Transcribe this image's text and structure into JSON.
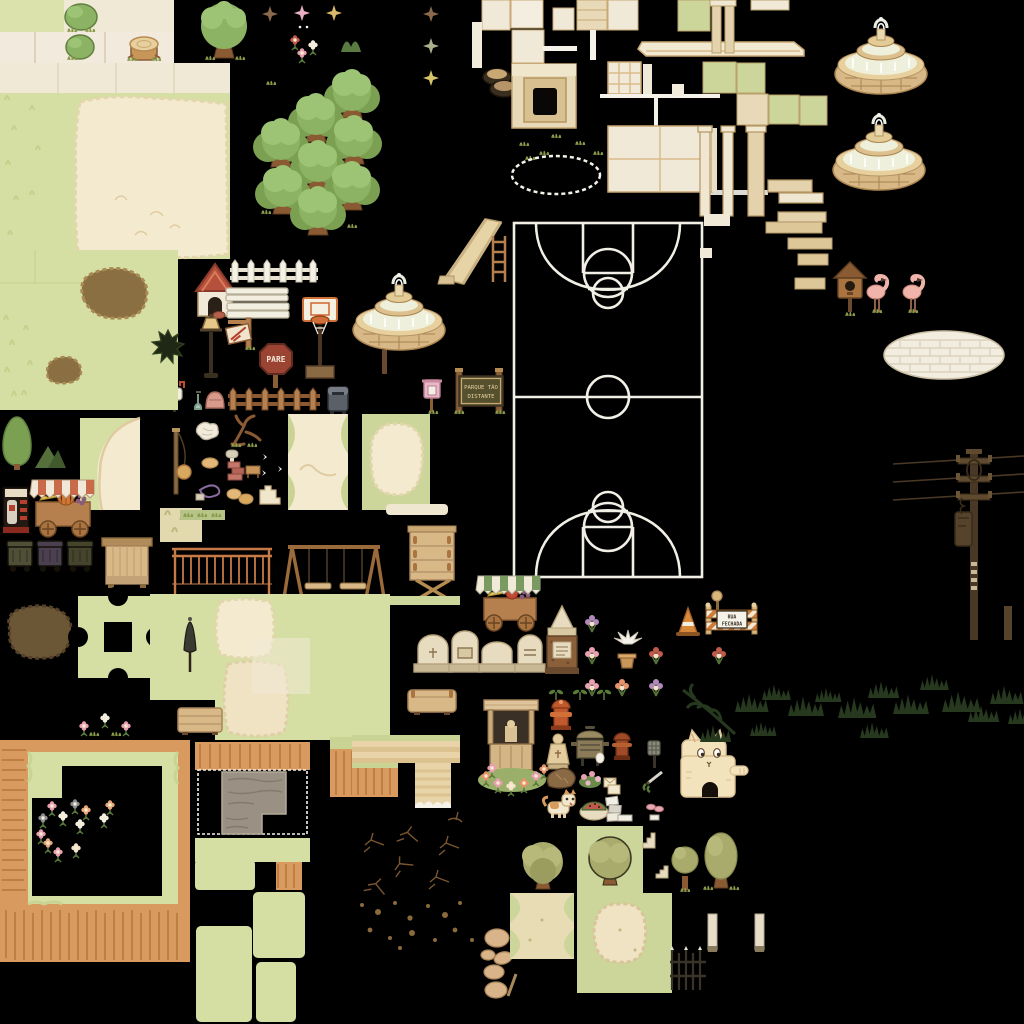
{
  "app": {
    "type": "pixel-art tileset spritesheet",
    "theme": "park and town exterior props",
    "background_color": "#000000",
    "canvas": {
      "width": 1024,
      "height": 1024
    }
  },
  "palette": {
    "pale_green": "#d6dfa3",
    "green_tile": "#ccd69a",
    "cream": "#f0e9d8",
    "sand": "#f3ead0",
    "tan": "#ddc697",
    "wood": "#b5804e",
    "wood_dark": "#8a5a32",
    "cliff_orange": "#d89a5e",
    "cliff_dark": "#c07f42",
    "tree_green": "#8cb364",
    "olive_green": "#a9ab6c",
    "white": "#f5f2ea",
    "stop_red": "#9c4434",
    "awning_red": "#c96a4a",
    "awning_green": "#7a9a62",
    "flamingo_pink": "#f0b4ab",
    "foliage_dark": "#26381e",
    "pole_brown": "#4a3826",
    "cat_cream": "#f2e3bc"
  },
  "signs": {
    "stop": "PARE",
    "park": {
      "line1": "PARQUE TÃO",
      "line2": "DISTANTE"
    },
    "road_closed": {
      "line1": "RUA",
      "line2": "FECHADA"
    }
  },
  "sprites": [
    {
      "name": "ground-tile-green",
      "bbox": [
        0,
        0,
        64,
        32
      ]
    },
    {
      "name": "ground-tile-cream",
      "bbox": [
        64,
        0,
        110,
        32
      ]
    },
    {
      "name": "ground-tile-row",
      "bbox": [
        0,
        32,
        174,
        31
      ]
    },
    {
      "name": "bush-large",
      "bbox": [
        64,
        4,
        32,
        28
      ]
    },
    {
      "name": "bush-small",
      "bbox": [
        66,
        34,
        28,
        26
      ]
    },
    {
      "name": "tree-stump",
      "bbox": [
        128,
        34,
        32,
        26
      ]
    },
    {
      "name": "tree-single",
      "bbox": [
        196,
        2,
        56,
        58
      ]
    },
    {
      "name": "sparkle-brown",
      "bbox": [
        263,
        6,
        15,
        17
      ]
    },
    {
      "name": "sparkle-pink",
      "bbox": [
        296,
        5,
        13,
        18
      ]
    },
    {
      "name": "sparkle-gold",
      "bbox": [
        328,
        6,
        13,
        17
      ]
    },
    {
      "name": "flowers-trio",
      "bbox": [
        288,
        34,
        32,
        28
      ]
    },
    {
      "name": "grass-tuft",
      "bbox": [
        266,
        76,
        12,
        10
      ]
    },
    {
      "name": "grass-arches",
      "bbox": [
        341,
        35,
        21,
        17
      ]
    },
    {
      "name": "sparkle-column",
      "bbox": [
        424,
        5,
        15,
        82
      ]
    },
    {
      "name": "sand-terrace-large",
      "bbox": [
        0,
        63,
        230,
        196
      ]
    },
    {
      "name": "tree-cluster",
      "bbox": [
        255,
        62,
        135,
        172
      ]
    },
    {
      "name": "cream-wall-tiles",
      "bbox": [
        470,
        0,
        170,
        65
      ]
    },
    {
      "name": "tires-stack",
      "bbox": [
        483,
        68,
        30,
        28
      ]
    },
    {
      "name": "sandbox-pit",
      "bbox": [
        512,
        64,
        64,
        64
      ]
    },
    {
      "name": "grass-tufts-scatter",
      "bbox": [
        516,
        130,
        88,
        30
      ]
    },
    {
      "name": "chalk-ellipse",
      "bbox": [
        512,
        156,
        88,
        38
      ]
    },
    {
      "name": "window-grid-tile",
      "bbox": [
        608,
        62,
        33,
        32
      ]
    },
    {
      "name": "cream-floor-2x2",
      "bbox": [
        608,
        126,
        104,
        66
      ]
    },
    {
      "name": "wall-cornice",
      "bbox": [
        640,
        38,
        170,
        22
      ]
    },
    {
      "name": "green-checker-tiles",
      "bbox": [
        678,
        0,
        150,
        126
      ]
    },
    {
      "name": "beige-pillars",
      "bbox": [
        698,
        126,
        66,
        90
      ]
    },
    {
      "name": "beige-steps",
      "bbox": [
        766,
        180,
        60,
        42
      ]
    },
    {
      "name": "fountain-large-1",
      "bbox": [
        835,
        12,
        92,
        86
      ]
    },
    {
      "name": "fountain-large-2",
      "bbox": [
        833,
        106,
        94,
        90
      ]
    },
    {
      "name": "slide",
      "bbox": [
        440,
        215,
        68,
        68
      ]
    },
    {
      "name": "ladder",
      "bbox": [
        490,
        236,
        18,
        46
      ]
    },
    {
      "name": "basketball-court",
      "bbox": [
        513,
        222,
        190,
        356
      ]
    },
    {
      "name": "court-side-fragments",
      "bbox": [
        700,
        214,
        130,
        100
      ]
    },
    {
      "name": "doghouse",
      "bbox": [
        196,
        262,
        40,
        56
      ]
    },
    {
      "name": "dog-bowl",
      "bbox": [
        213,
        312,
        12,
        8
      ]
    },
    {
      "name": "white-picket-fence",
      "bbox": [
        230,
        260,
        90,
        24
      ]
    },
    {
      "name": "white-sign-boards",
      "bbox": [
        226,
        288,
        62,
        32
      ]
    },
    {
      "name": "lamppost",
      "bbox": [
        202,
        316,
        20,
        62
      ]
    },
    {
      "name": "hanging-shop-sign",
      "bbox": [
        226,
        318,
        28,
        28
      ]
    },
    {
      "name": "stop-sign",
      "bbox": [
        262,
        342,
        28,
        48
      ]
    },
    {
      "name": "basketball-hoop",
      "bbox": [
        303,
        296,
        36,
        82
      ]
    },
    {
      "name": "fountain-medium",
      "bbox": [
        352,
        266,
        95,
        88
      ]
    },
    {
      "name": "fountain-post",
      "bbox": [
        382,
        350,
        6,
        24
      ]
    },
    {
      "name": "brown-picket-fence",
      "bbox": [
        228,
        386,
        92,
        26
      ]
    },
    {
      "name": "mailbox-white",
      "bbox": [
        168,
        384,
        16,
        28
      ]
    },
    {
      "name": "shovel-and-pot",
      "bbox": [
        194,
        388,
        28,
        22
      ]
    },
    {
      "name": "mail-bin-blue",
      "bbox": [
        326,
        383,
        24,
        34
      ]
    },
    {
      "name": "birdhouse-pink",
      "bbox": [
        422,
        378,
        20,
        34
      ]
    },
    {
      "name": "park-sign-parque-tao-distante",
      "bbox": [
        452,
        366,
        56,
        50
      ]
    },
    {
      "name": "green-field-dirt-patch",
      "bbox": [
        0,
        250,
        182,
        160
      ]
    },
    {
      "name": "spiky-bush-dark",
      "bbox": [
        156,
        326,
        26,
        34
      ]
    },
    {
      "name": "path-corner-tile",
      "bbox": [
        80,
        418,
        60,
        92
      ]
    },
    {
      "name": "cypress-trees",
      "bbox": [
        0,
        416,
        66,
        52
      ]
    },
    {
      "name": "vending-machine",
      "bbox": [
        3,
        487,
        26,
        46
      ]
    },
    {
      "name": "fruit-cart-red",
      "bbox": [
        32,
        480,
        62,
        58
      ]
    },
    {
      "name": "tetherball-pole",
      "bbox": [
        168,
        428,
        24,
        70
      ]
    },
    {
      "name": "sand-tile-small",
      "bbox": [
        160,
        508,
        42,
        34
      ]
    },
    {
      "name": "trash-bins-trio",
      "bbox": [
        6,
        540,
        92,
        34
      ]
    },
    {
      "name": "wooden-stall",
      "bbox": [
        102,
        538,
        50,
        48
      ]
    },
    {
      "name": "monkey-bars",
      "bbox": [
        172,
        546,
        100,
        52
      ]
    },
    {
      "name": "swing-set",
      "bbox": [
        288,
        543,
        92,
        56
      ]
    },
    {
      "name": "wooden-stand-tall",
      "bbox": [
        408,
        524,
        48,
        80
      ]
    },
    {
      "name": "crumpled-map",
      "bbox": [
        196,
        422,
        22,
        18
      ]
    },
    {
      "name": "bare-branch",
      "bbox": [
        228,
        413,
        34,
        34
      ]
    },
    {
      "name": "picnic-items",
      "bbox": [
        196,
        452,
        90,
        56
      ]
    },
    {
      "name": "sand-tile-corners",
      "bbox": [
        288,
        414,
        60,
        96
      ]
    },
    {
      "name": "green-tile-sand-center",
      "bbox": [
        362,
        414,
        68,
        96
      ]
    },
    {
      "name": "grass-strip",
      "bbox": [
        180,
        508,
        45,
        14
      ]
    },
    {
      "name": "sand-bar",
      "bbox": [
        386,
        504,
        62,
        12
      ]
    },
    {
      "name": "pale-strip",
      "bbox": [
        360,
        596,
        100,
        9
      ]
    },
    {
      "name": "dirt-blob-dark",
      "bbox": [
        4,
        606,
        68,
        62
      ]
    },
    {
      "name": "jigsaw-tile",
      "bbox": [
        78,
        596,
        78,
        82
      ]
    },
    {
      "name": "terrain-sand-patches",
      "bbox": [
        150,
        594,
        240,
        146
      ]
    },
    {
      "name": "closed-parasol",
      "bbox": [
        180,
        618,
        20,
        56
      ]
    },
    {
      "name": "flower-tufts-row",
      "bbox": [
        74,
        710,
        66,
        30
      ]
    },
    {
      "name": "wooden-crate",
      "bbox": [
        178,
        706,
        44,
        28
      ]
    },
    {
      "name": "cliff-ledges",
      "bbox": [
        330,
        733,
        130,
        76
      ]
    },
    {
      "name": "bench-box",
      "bbox": [
        408,
        688,
        48,
        26
      ]
    },
    {
      "name": "cliff-terrain-flowers",
      "bbox": [
        0,
        740,
        190,
        222
      ]
    },
    {
      "name": "cliff-terrain-stonepath",
      "bbox": [
        195,
        740,
        118,
        124
      ]
    },
    {
      "name": "green-path-pieces",
      "bbox": [
        195,
        858,
        110,
        166
      ]
    },
    {
      "name": "crack-decals",
      "bbox": [
        355,
        826,
        125,
        74
      ]
    },
    {
      "name": "pebble-dots",
      "bbox": [
        355,
        898,
        125,
        55
      ]
    },
    {
      "name": "stones-pile",
      "bbox": [
        480,
        926,
        38,
        76
      ]
    },
    {
      "name": "fruit-cart-green",
      "bbox": [
        478,
        574,
        62,
        62
      ]
    },
    {
      "name": "gravestones-row",
      "bbox": [
        414,
        634,
        130,
        40
      ]
    },
    {
      "name": "obelisk-monument",
      "bbox": [
        545,
        606,
        34,
        66
      ]
    },
    {
      "name": "flower-bouquets",
      "bbox": [
        580,
        606,
        150,
        94
      ]
    },
    {
      "name": "dove-and-pot",
      "bbox": [
        611,
        634,
        28,
        36
      ]
    },
    {
      "name": "traffic-cone",
      "bbox": [
        676,
        606,
        24,
        30
      ]
    },
    {
      "name": "round-sign-post",
      "bbox": [
        712,
        590,
        12,
        26
      ]
    },
    {
      "name": "barricade-rua-fechada",
      "bbox": [
        704,
        602,
        56,
        34
      ]
    },
    {
      "name": "seedling-sprouts",
      "bbox": [
        550,
        684,
        64,
        18
      ]
    },
    {
      "name": "well-shrine",
      "bbox": [
        478,
        698,
        72,
        94
      ]
    },
    {
      "name": "fire-hydrant-1",
      "bbox": [
        549,
        700,
        24,
        32
      ]
    },
    {
      "name": "statue-figure",
      "bbox": [
        548,
        732,
        22,
        36
      ]
    },
    {
      "name": "grill",
      "bbox": [
        571,
        725,
        38,
        42
      ]
    },
    {
      "name": "egg",
      "bbox": [
        596,
        752,
        9,
        11
      ]
    },
    {
      "name": "fire-hydrant-2",
      "bbox": [
        612,
        732,
        20,
        30
      ]
    },
    {
      "name": "fly-swatter",
      "bbox": [
        646,
        740,
        14,
        28
      ]
    },
    {
      "name": "shears",
      "bbox": [
        643,
        768,
        22,
        18
      ]
    },
    {
      "name": "boulder",
      "bbox": [
        545,
        766,
        28,
        22
      ]
    },
    {
      "name": "flower-cluster",
      "bbox": [
        578,
        768,
        24,
        20
      ]
    },
    {
      "name": "envelopes",
      "bbox": [
        602,
        774,
        18,
        20
      ]
    },
    {
      "name": "cat-playhouse",
      "bbox": [
        678,
        728,
        72,
        70
      ]
    },
    {
      "name": "shiba-dog",
      "bbox": [
        544,
        792,
        32,
        28
      ]
    },
    {
      "name": "watermelon-dish",
      "bbox": [
        580,
        798,
        28,
        22
      ]
    },
    {
      "name": "paper-shoes-stack",
      "bbox": [
        604,
        794,
        18,
        26
      ]
    },
    {
      "name": "pink-shoes",
      "bbox": [
        646,
        800,
        16,
        12
      ]
    },
    {
      "name": "birdhouse-brown",
      "bbox": [
        836,
        264,
        28,
        50
      ]
    },
    {
      "name": "flamingo-1",
      "bbox": [
        862,
        270,
        30,
        50
      ]
    },
    {
      "name": "flamingo-2",
      "bbox": [
        898,
        270,
        30,
        50
      ]
    },
    {
      "name": "brick-oval-patio",
      "bbox": [
        884,
        330,
        120,
        50
      ]
    },
    {
      "name": "utility-pole-wires",
      "bbox": [
        893,
        450,
        131,
        192
      ]
    },
    {
      "name": "short-post",
      "bbox": [
        1004,
        606,
        8,
        34
      ]
    },
    {
      "name": "dark-foliage-band",
      "bbox": [
        680,
        664,
        344,
        82
      ]
    },
    {
      "name": "olive-tree-big",
      "bbox": [
        510,
        830,
        66,
        66
      ]
    },
    {
      "name": "olive-tree-tiles",
      "bbox": [
        577,
        826,
        66,
        70
      ]
    },
    {
      "name": "olive-tree-small",
      "bbox": [
        672,
        836,
        26,
        56
      ]
    },
    {
      "name": "olive-tree-oval",
      "bbox": [
        704,
        830,
        34,
        60
      ]
    },
    {
      "name": "sand-tile-green-corners",
      "bbox": [
        510,
        893,
        64,
        66
      ]
    },
    {
      "name": "green-tile-sand-blob",
      "bbox": [
        577,
        893,
        95,
        100
      ]
    },
    {
      "name": "iron-fence",
      "bbox": [
        668,
        946,
        40,
        44
      ]
    },
    {
      "name": "cream-pillar-1",
      "bbox": [
        708,
        914,
        9,
        40
      ]
    },
    {
      "name": "cream-pillar-2",
      "bbox": [
        755,
        914,
        9,
        40
      ]
    },
    {
      "name": "tiny-stairs-icons",
      "bbox": [
        616,
        812,
        52,
        70
      ]
    }
  ]
}
